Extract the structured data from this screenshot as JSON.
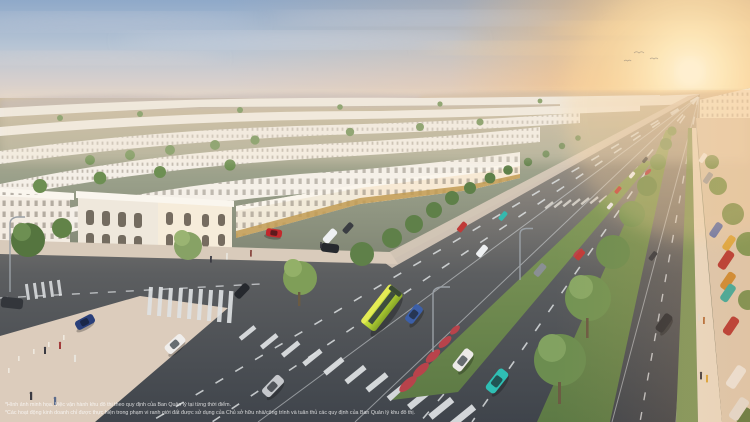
{
  "image": {
    "kind": "aerial-masterplan-render",
    "subject": "sunset aerial render of a low-rise urban township: curved rows of white neoclassical shophouses on the left, a wide multi-lane tree-lined boulevard running to a vanishing point at the sun, cars, a lime-green bus, zebra crosswalks, parked cars along the right edge"
  },
  "disclaimer": {
    "line1": "*Hình ảnh minh họa. Việc vận hành khu đô thị theo quy định của Ban Quản lý tại từng thời điểm.",
    "line2": "*Các hoạt động kinh doanh chỉ được thực hiện trong phạm vi ranh giới đất được sử dụng của Chủ sở hữu nhà/công trình và tuân thủ các quy định của Ban Quản lý khu đô thị."
  },
  "palette": {
    "sky_top": "#8fa9c9",
    "sky_haze": "#e6d6c6",
    "sun_glow": "#ffd795",
    "sun_core": "#fffbe8",
    "building_white": "#f3eee6",
    "building_lit": "#f6ecda",
    "building_gold_base": "#c29b52",
    "window_dark": "#5a5146",
    "tree_green": "#6d8f52",
    "tree_dark": "#4a6538",
    "grass_median": "#7f9a5e",
    "flower_red": "#b8434b",
    "asphalt_near": "#3f444b",
    "asphalt_far": "#bfae96",
    "lane_marking": "#e4e7e9",
    "plaza_pavement": "#dcccbc",
    "sidewalk_right": "#e6dbc9",
    "bus_lime": "#b5d334",
    "car_teal": "#2fbfb4",
    "car_red": "#c03a38",
    "car_blue": "#2a3f7a",
    "car_white": "#eceae8"
  }
}
